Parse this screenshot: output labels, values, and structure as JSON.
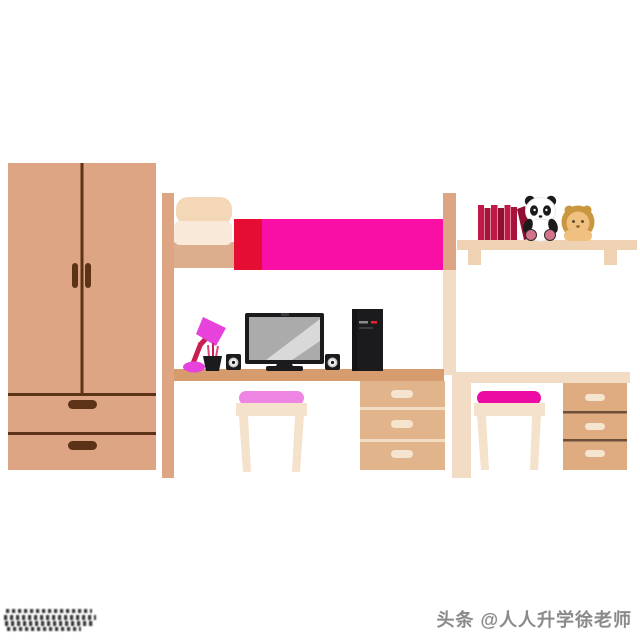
{
  "canvas": {
    "width": 640,
    "height": 640,
    "background": "#ffffff"
  },
  "watermark": {
    "bottom_right_text": "头条 @人人升学徐老师"
  },
  "objects": [
    "wardrobe",
    "loft-bed",
    "pillow",
    "blanket",
    "desk-left",
    "desk-right",
    "wall-shelf",
    "books",
    "panda-plush",
    "lion-plush",
    "desk-lamp",
    "pen-cup",
    "monitor",
    "speakers",
    "pc-tower",
    "stool-left",
    "stool-right",
    "drawer-unit-left",
    "drawer-unit-right"
  ],
  "palette": {
    "wood": "#DDA584",
    "woodLight": "#DCAE8D",
    "woodDark": "#5D3317",
    "deskLeft": "#D79C6D",
    "drawerLeft": "#E2B48C",
    "drawerRight": "#DFAB80",
    "drawerLineLight": "#F2DDC4",
    "drawerLineDark": "#6E4F3A",
    "cream": "#F2DCC6",
    "shelfCream": "#EFD2B4",
    "stoolCream": "#F5E2CC",
    "handleCream": "#F5E4CF",
    "pillowTop": "#F3D7B6",
    "pillowBottom": "#F9E9D8",
    "blanketRed": "#E50D32",
    "blanketPink": "#F90FA5",
    "stoolPinkLight": "#EE85E3",
    "stoolPinkDeep": "#EC0CA4",
    "lampMagenta": "#E743DC",
    "lampArm": "#C81E50",
    "black": "#1B1B1E",
    "screenGray": "#ABABAB",
    "bookA": "#C21847",
    "bookB": "#A8133B",
    "bookC": "#8E0F30",
    "pandaPink": "#D4748C",
    "lionMane": "#C9973E",
    "lionFace": "#EFC080",
    "watermarkGray": "#8A8A8A",
    "towerLed": "#E8252F"
  }
}
